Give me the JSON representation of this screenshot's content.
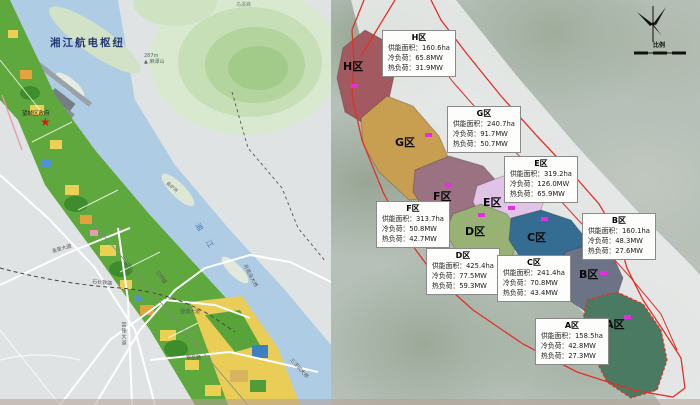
{
  "left_map": {
    "title": "湘江航电枢纽",
    "peak": {
      "elevation": "287m",
      "marker": "▲",
      "name": "麻潭山"
    },
    "hill_label": "鸟溪峰",
    "government": "望城区政府",
    "government_star": "★",
    "river": "湘 江",
    "island": "香炉洲",
    "roads": {
      "jinxing_avenue": "金星大道",
      "shichang_railway": "石长铁路",
      "third_ring_road": "三环路",
      "leifeng_avenue": "雷锋大道",
      "wangcheng_avenue": "望城大道",
      "yinxing_road": "银星路",
      "yueliangdao_bridge": "月亮岛大桥",
      "sanchaji_bridge": "三汊矶大桥"
    }
  },
  "right_map": {
    "scale_label": "比例",
    "boundary_color": "#e23026",
    "marker_color": "#e62ee0",
    "field_labels": {
      "area": "供能面积：",
      "cooling": "冷负荷：",
      "heating": "热负荷："
    },
    "districts": [
      {
        "name": "H区",
        "supply_area": "160.6ha",
        "cooling_load": "65.8MW",
        "heating_load": "31.9MW",
        "color": "#a2595f"
      },
      {
        "name": "G区",
        "supply_area": "240.7ha",
        "cooling_load": "91.7MW",
        "heating_load": "50.7MW",
        "color": "#c89e50"
      },
      {
        "name": "F区",
        "supply_area": "313.7ha",
        "cooling_load": "50.8MW",
        "heating_load": "42.7MW",
        "color": "#9a7282"
      },
      {
        "name": "E区",
        "supply_area": "319.2ha",
        "cooling_load": "126.0MW",
        "heating_load": "65.9MW",
        "color": "#e0c3e6"
      },
      {
        "name": "D区",
        "supply_area": "425.4ha",
        "cooling_load": "77.5MW",
        "heating_load": "59.3MW",
        "color": "#97b274"
      },
      {
        "name": "C区",
        "supply_area": "241.4ha",
        "cooling_load": "70.8MW",
        "heating_load": "43.4MW",
        "color": "#356d92"
      },
      {
        "name": "B区",
        "supply_area": "160.1ha",
        "cooling_load": "48.3MW",
        "heating_load": "27.6MW",
        "color": "#6d7386"
      },
      {
        "name": "A区",
        "supply_area": "158.5ha",
        "cooling_load": "42.8MW",
        "heating_load": "27.3MW",
        "color": "#4a7a61"
      }
    ]
  }
}
